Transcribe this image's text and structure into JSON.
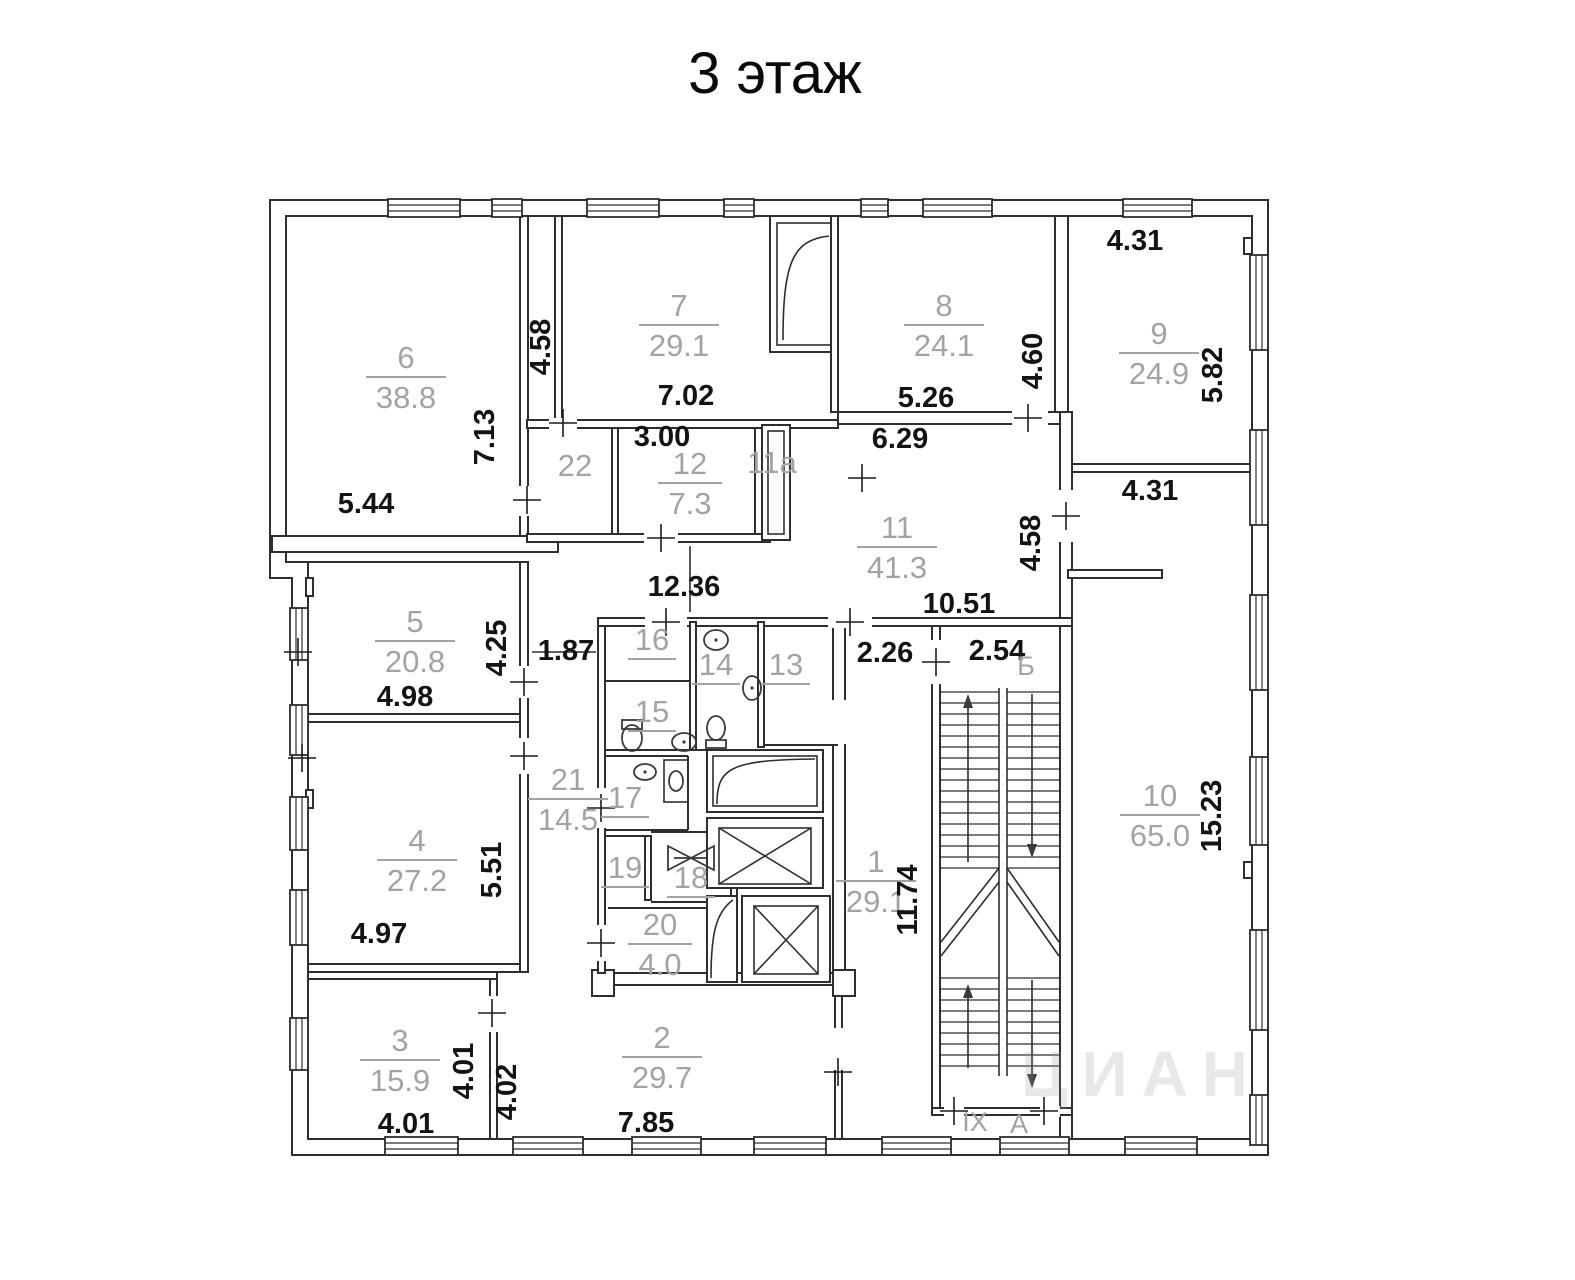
{
  "title": "3 этаж",
  "colors": {
    "room_label": "#a3a3a3",
    "dim_label": "#141414",
    "wall_line": "#2e2e2e"
  },
  "watermark": {
    "text": "ЦИАН",
    "x": 1262,
    "y": 1096
  },
  "rooms": [
    {
      "number": "6",
      "area": "38.8",
      "x": 406,
      "y": 368,
      "underline": true
    },
    {
      "number": "7",
      "area": "29.1",
      "x": 679,
      "y": 316,
      "underline": true
    },
    {
      "number": "8",
      "area": "24.1",
      "x": 944,
      "y": 316,
      "underline": true
    },
    {
      "number": "9",
      "area": "24.9",
      "x": 1159,
      "y": 344,
      "underline": true
    },
    {
      "number": "5",
      "area": "20.8",
      "x": 415,
      "y": 632,
      "underline": true
    },
    {
      "number": "4",
      "area": "27.2",
      "x": 417,
      "y": 851,
      "underline": true
    },
    {
      "number": "3",
      "area": "15.9",
      "x": 400,
      "y": 1051,
      "underline": true
    },
    {
      "number": "2",
      "area": "29.7",
      "x": 662,
      "y": 1048,
      "underline": true
    },
    {
      "number": "1",
      "area": "29.1",
      "x": 876,
      "y": 872,
      "underline": true
    },
    {
      "number": "10",
      "area": "65.0",
      "x": 1160,
      "y": 806,
      "underline": true
    },
    {
      "number": "11",
      "area": "41.3",
      "x": 897,
      "y": 538,
      "underline": true
    },
    {
      "number": "12",
      "area": "7.3",
      "x": 690,
      "y": 474,
      "underline": true
    },
    {
      "number": "20",
      "area": "4.0",
      "x": 660,
      "y": 935,
      "underline": true
    },
    {
      "number": "21",
      "area": "14.5",
      "x": 568,
      "y": 790,
      "underline": true
    },
    {
      "number": "22",
      "area": null,
      "x": 575,
      "y": 476,
      "underline": false
    },
    {
      "number": "11а",
      "area": null,
      "x": 772,
      "y": 473,
      "underline": false
    },
    {
      "number": "13",
      "area": null,
      "x": 786,
      "y": 675,
      "underline": true
    },
    {
      "number": "14",
      "area": null,
      "x": 716,
      "y": 675,
      "underline": true
    },
    {
      "number": "15",
      "area": null,
      "x": 652,
      "y": 722,
      "underline": true
    },
    {
      "number": "16",
      "area": null,
      "x": 652,
      "y": 650,
      "underline": true
    },
    {
      "number": "17",
      "area": null,
      "x": 625,
      "y": 808,
      "underline": true
    },
    {
      "number": "19",
      "area": null,
      "x": 625,
      "y": 878,
      "underline": true
    },
    {
      "number": "18",
      "area": null,
      "x": 691,
      "y": 888,
      "underline": true
    }
  ],
  "dimensions": [
    {
      "text": "5.44",
      "x": 366,
      "y": 513,
      "rot": 0
    },
    {
      "text": "7.13",
      "x": 494,
      "y": 437,
      "rot": -90
    },
    {
      "text": "4.58",
      "x": 550,
      "y": 347,
      "rot": -90
    },
    {
      "text": "7.02",
      "x": 686,
      "y": 405,
      "rot": 0
    },
    {
      "text": "3.00",
      "x": 662,
      "y": 446,
      "rot": 0
    },
    {
      "text": "12.36",
      "x": 684,
      "y": 596,
      "rot": 0
    },
    {
      "text": "1.87",
      "x": 566,
      "y": 660,
      "rot": 0
    },
    {
      "text": "4.25",
      "x": 506,
      "y": 648,
      "rot": -90
    },
    {
      "text": "4.98",
      "x": 405,
      "y": 706,
      "rot": 0
    },
    {
      "text": "5.51",
      "x": 501,
      "y": 870,
      "rot": -90
    },
    {
      "text": "4.97",
      "x": 379,
      "y": 943,
      "rot": 0
    },
    {
      "text": "4.01",
      "x": 406,
      "y": 1133,
      "rot": 0
    },
    {
      "text": "4.01",
      "x": 473,
      "y": 1071,
      "rot": -90
    },
    {
      "text": "4.02",
      "x": 516,
      "y": 1092,
      "rot": -90
    },
    {
      "text": "7.85",
      "x": 646,
      "y": 1132,
      "rot": 0
    },
    {
      "text": "5.26",
      "x": 926,
      "y": 407,
      "rot": 0
    },
    {
      "text": "6.29",
      "x": 900,
      "y": 448,
      "rot": 0
    },
    {
      "text": "4.60",
      "x": 1042,
      "y": 361,
      "rot": -90
    },
    {
      "text": "4.31",
      "x": 1135,
      "y": 250,
      "rot": 0
    },
    {
      "text": "5.82",
      "x": 1222,
      "y": 375,
      "rot": -90
    },
    {
      "text": "10.51",
      "x": 959,
      "y": 613,
      "rot": 0
    },
    {
      "text": "4.58",
      "x": 1040,
      "y": 543,
      "rot": -90
    },
    {
      "text": "2.26",
      "x": 885,
      "y": 662,
      "rot": 0
    },
    {
      "text": "2.54",
      "x": 997,
      "y": 660,
      "rot": 0
    },
    {
      "text": "4.31",
      "x": 1150,
      "y": 500,
      "rot": 0
    },
    {
      "text": "15.23",
      "x": 1221,
      "y": 816,
      "rot": -90
    },
    {
      "text": "11.74",
      "x": 917,
      "y": 900,
      "rot": -90
    }
  ],
  "stair_labels": [
    {
      "text": "Б",
      "x": 1026,
      "y": 675
    },
    {
      "text": "IX",
      "x": 975,
      "y": 1131
    },
    {
      "text": "А",
      "x": 1019,
      "y": 1133
    }
  ]
}
